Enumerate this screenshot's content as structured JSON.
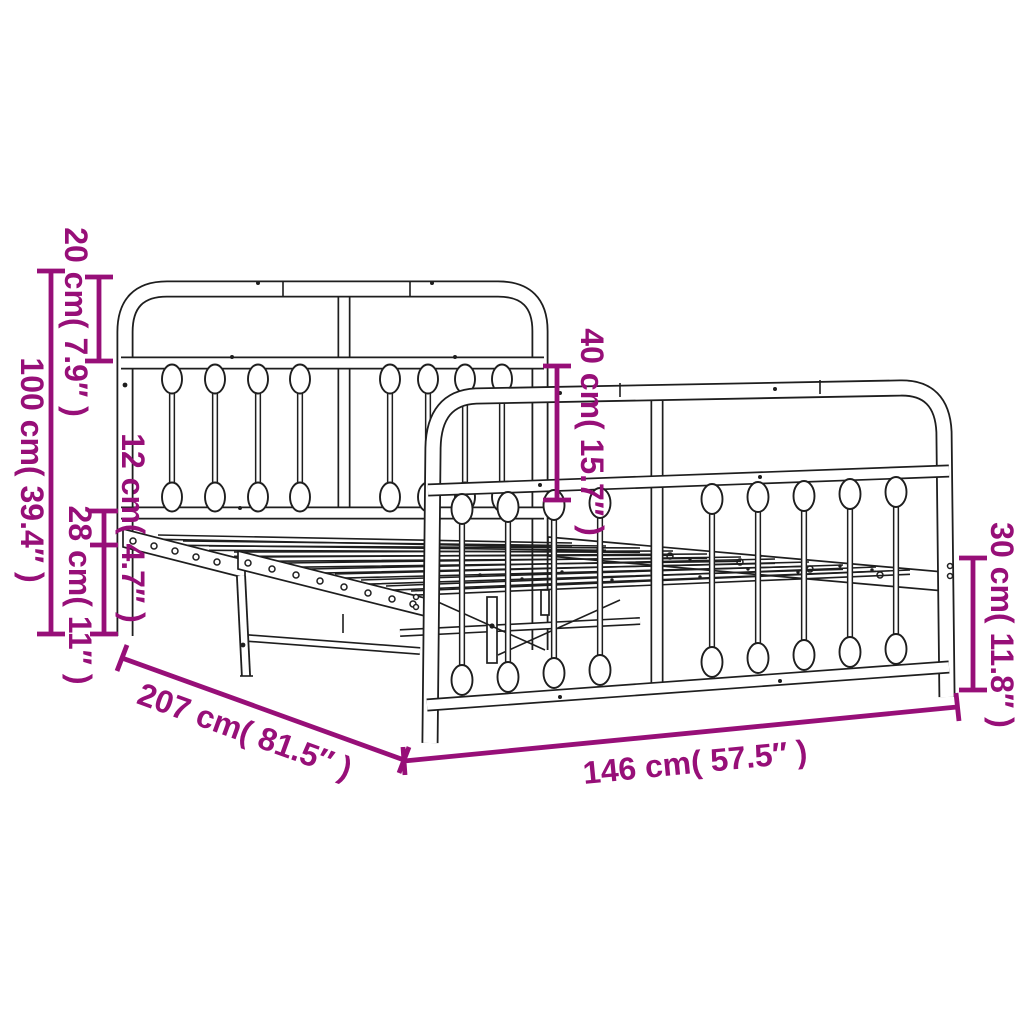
{
  "diagram": {
    "title": "metal bed frame dimension diagram",
    "colors": {
      "dimension_accent": "#970f78",
      "line_art": "#1e1e1e",
      "background": "#ffffff"
    },
    "dimensions": {
      "headboard_total_height": {
        "cm": "100",
        "inches": "39.4",
        "label": "100 cm( 39.4″ )"
      },
      "headboard_top_section": {
        "cm": "20",
        "inches": "7.9",
        "label": "20 cm( 7.9″ )"
      },
      "rail_to_base_gap": {
        "cm": "12",
        "inches": "4.7",
        "label": "12 cm( 4.7″ )"
      },
      "underbed_clearance": {
        "cm": "28",
        "inches": "11",
        "label": "28 cm( 11″ )"
      },
      "footboard_top_section": {
        "cm": "40",
        "inches": "15.7",
        "label": "40 cm( 15.7″ )"
      },
      "footboard_leg_height": {
        "cm": "30",
        "inches": "11.8",
        "label": "30 cm( 11.8″ )"
      },
      "frame_length": {
        "cm": "207",
        "inches": "81.5",
        "label": "207 cm( 81.5″ )"
      },
      "frame_width": {
        "cm": "146",
        "inches": "57.5",
        "label": "146 cm( 57.5″ )"
      }
    }
  }
}
